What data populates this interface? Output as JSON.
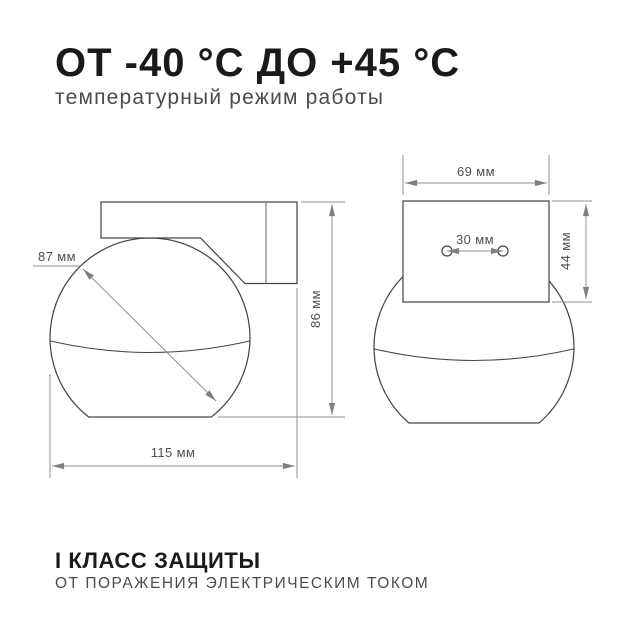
{
  "header": {
    "title": "ОТ -40 °С ДО +45 °С",
    "subtitle": "температурный режим работы"
  },
  "drawings": {
    "side_view": {
      "sphere_diameter": "87 мм",
      "total_width": "115 мм",
      "total_height": "86 мм"
    },
    "front_view": {
      "bracket_width": "69 мм",
      "hole_spacing": "30 мм",
      "bracket_height": "44 мм"
    }
  },
  "footer": {
    "title": "I КЛАСС ЗАЩИТЫ",
    "subtitle": "ОТ ПОРАЖЕНИЯ ЭЛЕКТРИЧЕСКИМ ТОКОМ"
  },
  "colors": {
    "background": "#ffffff",
    "text_primary": "#1a1a1a",
    "text_secondary": "#4a4a4a",
    "outline": "#474747",
    "dimension_line": "#8f8f8f"
  }
}
